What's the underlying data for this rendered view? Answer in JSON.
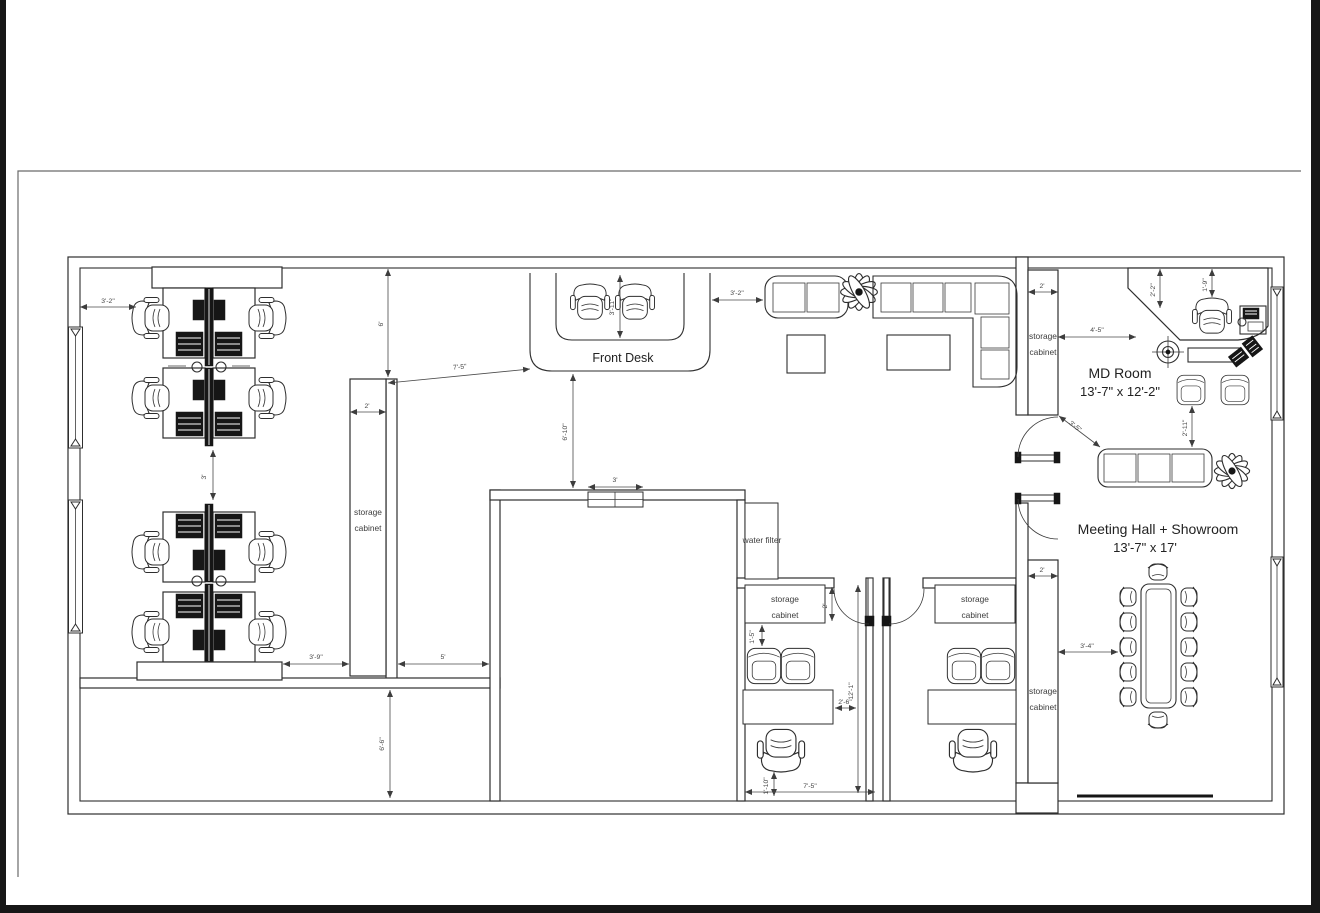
{
  "colors": {
    "line": "#2e2e2e",
    "dimension": "#4a4a4a",
    "page_edge": "#171717",
    "paper": "#ffffff"
  },
  "labels": {
    "front_desk": "Front Desk",
    "md_room_name": "MD Room",
    "md_room_size": "13'-7\" x 12'-2\"",
    "meeting_hall_name": "Meeting Hall + Showroom",
    "meeting_hall_size": "13'-7\" x 17'",
    "water_filter": "water filter",
    "storage": "storage",
    "cabinet": "cabinet"
  },
  "dimensions": {
    "top_left_offset": "3'-2\"",
    "cluster_gap": "3'",
    "oo_cabinet_width": "2'",
    "wall_to_cabinet": "6'",
    "cabinet_to_desk": "7'-5\"",
    "cluster_to_cabinet": "3'-9\"",
    "hallway_width": "5'",
    "lower_room_depth": "6'-6\"",
    "front_desk_width": "3'-11\"",
    "desk_to_corridor": "6'-10\"",
    "shelf_width": "3'",
    "desk_to_sofa": "3'-2\"",
    "md_cabinet_width": "2'",
    "cabinet_to_md_desk": "4'-5\"",
    "md_wall_offset_a": "2'-2\"",
    "md_wall_offset_b": "1'-9\"",
    "cabinet_to_sofa": "3'-5\"",
    "chairs_to_sofa": "2'-11\"",
    "mh_cabinet_width": "2'",
    "cabinet_to_table": "3'-4\"",
    "office_cabinet_depth": "2'",
    "cabinet_to_chairs": "1'-5\"",
    "office_depth": "12'-1\"",
    "desk_to_wall": "2'-6\"",
    "chair_offset": "1'-10\"",
    "office_width": "7'-5\""
  }
}
